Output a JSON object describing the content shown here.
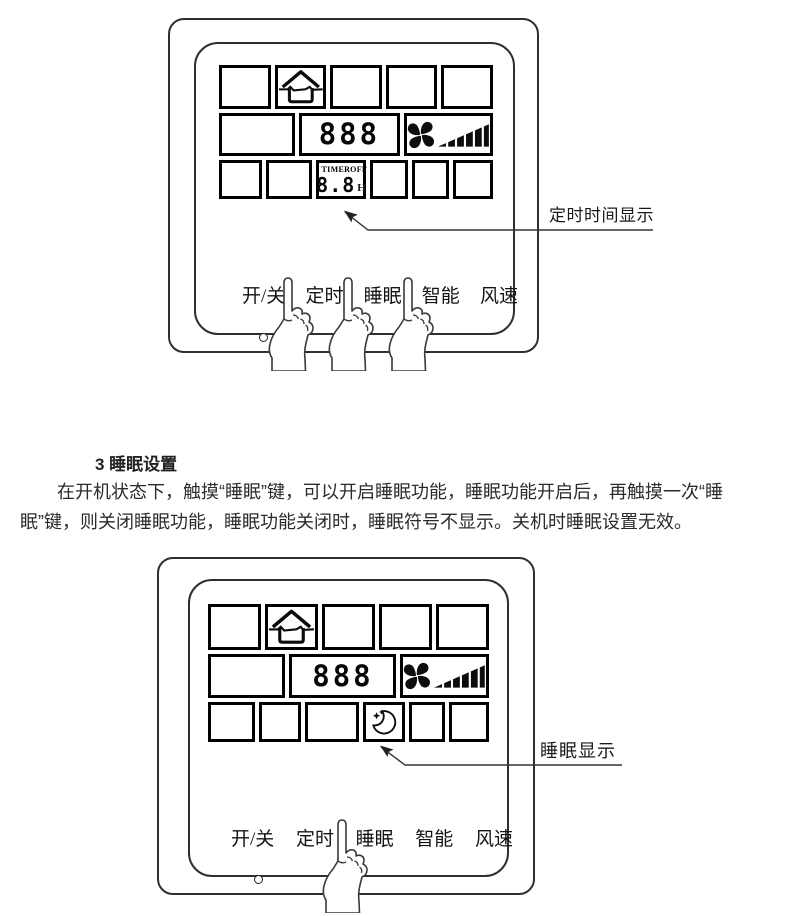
{
  "colors": {
    "ink": "#1c1c1c",
    "outline": "#2f2f2f",
    "lcd_border": "#000000",
    "background": "#ffffff"
  },
  "panel_top": {
    "buttons": [
      "开/关",
      "定时",
      "睡眠",
      "智能",
      "风速"
    ],
    "lcd": {
      "temp": "888",
      "timer_word": "TIMER",
      "timer_state": "OFF",
      "timer_value": "8.8",
      "timer_unit": "H",
      "icons": {
        "house": "house-airflow-icon",
        "fan": "fan-blades-icon",
        "bars": "fan-speed-bars-icon"
      }
    },
    "led": "power-led-dot",
    "hands": "pointing-hand-x3"
  },
  "annotation_top": {
    "label": "定时时间显示"
  },
  "section": {
    "heading": "3 睡眠设置",
    "body_lines": [
      "在开机状态下，触摸“睡眠”键，可以开启睡眠功能，睡眠功能开启后，再触摸一次“睡",
      "眠”键，则关闭睡眠功能，睡眠功能关闭时，睡眠符号不显示。关机时睡眠设置无效。"
    ]
  },
  "panel_bottom": {
    "buttons": [
      "开/关",
      "定时",
      "睡眠",
      "智能",
      "风速"
    ],
    "lcd": {
      "temp": "888",
      "icons": {
        "house": "house-airflow-icon",
        "fan": "fan-blades-icon",
        "bars": "fan-speed-bars-icon",
        "sleep": "sleep-moon-icon"
      }
    },
    "led": "power-led-dot",
    "hands": "pointing-hand-x1"
  },
  "annotation_bottom": {
    "label": "睡眠显示"
  }
}
